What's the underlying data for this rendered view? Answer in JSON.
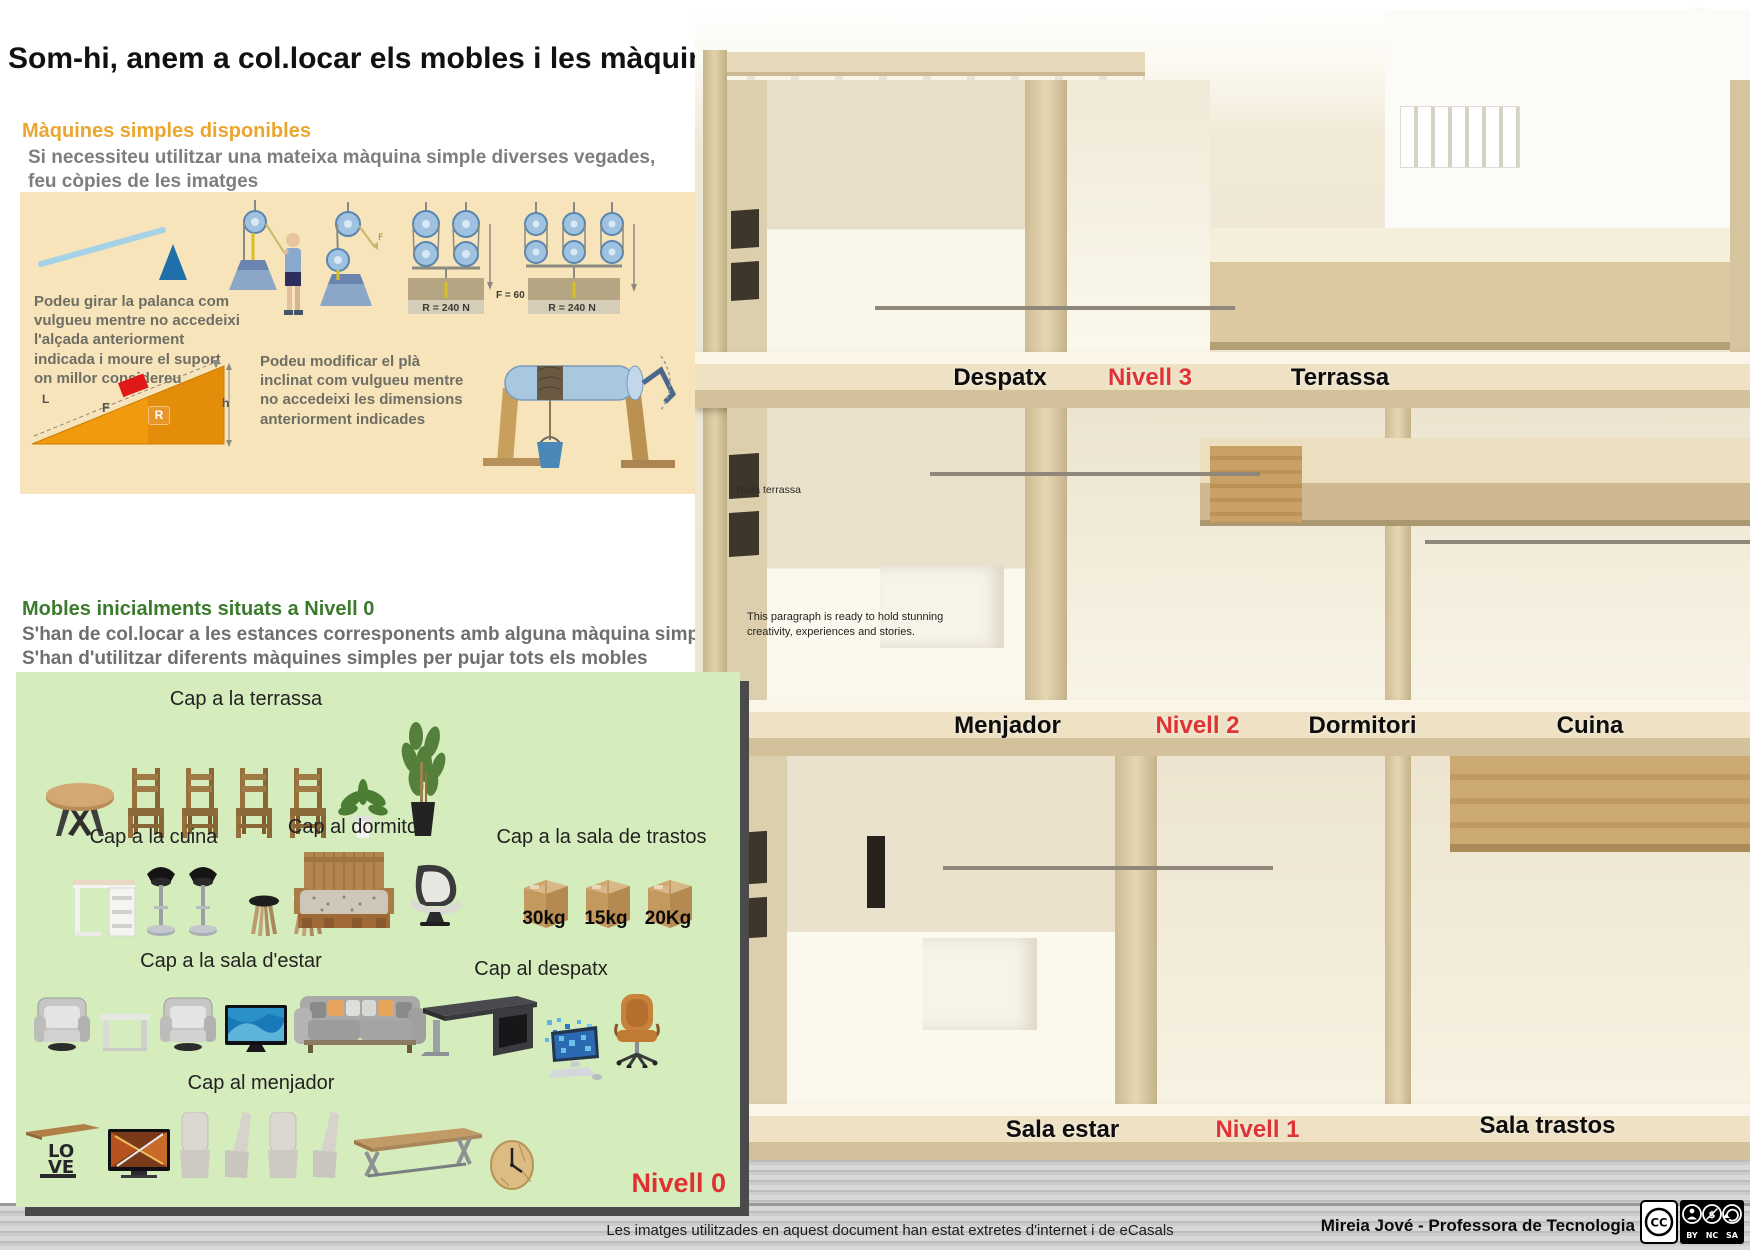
{
  "colors": {
    "accent_red": "#e03131",
    "heading_orange": "#eaa62e",
    "heading_green": "#3c7a2e",
    "tan_panel": "#f7e4ba",
    "green_panel": "#d5ecbc"
  },
  "header": {
    "title": "Som-hi, anem a col.locar els mobles i les màquines simples!!!",
    "back_line1": "A doc.",
    "back_line2": "anterior"
  },
  "machines": {
    "heading": "Màquines simples disponibles",
    "subheading": "Si necessiteu utilitzar una mateixa màquina simple diverses vegades, feu còpies de les imatges",
    "note_lever": "Podeu girar la palanca com vulgueu mentre no accedeixi l'alçada anteriorment indicada i moure el suport on millor considereu",
    "note_plane": "Podeu modificar el plà inclinat com vulgueu mentre no accedeixi les dimensions anteriorment indicades",
    "labels": {
      "r240_a": "R = 240 N",
      "f60": "F = 60 N",
      "r240_b": "R = 240 N",
      "plane_L": "L",
      "plane_F": "F",
      "plane_R": "R",
      "plane_h": "h"
    }
  },
  "furniture": {
    "heading": "Mobles inicialments situats a Nivell 0",
    "rule1": "S'han de col.locar a les estances corresponents amb alguna màquina simple",
    "rule2": "S'han d'utilitzar diferents màquines simples per pujar tots els mobles",
    "level_label": "Nivell 0",
    "groups": [
      {
        "label": "Cap a la terrassa",
        "items": [
          "table-round",
          "chair-wood",
          "chair-wood",
          "chair-wood",
          "chair-wood",
          "plant-small",
          "plant-tall"
        ]
      },
      {
        "label": "Cap a la cuina",
        "items": [
          "bar-table",
          "bar-stool",
          "bar-stool",
          "stool-dark",
          "stool-white"
        ]
      },
      {
        "label": "Cap al dormitori",
        "items": [
          "bed-pallet",
          "lounge-chair"
        ]
      },
      {
        "label": "Cap a la sala de trastos",
        "items": [
          {
            "type": "box",
            "label": "30kg"
          },
          {
            "type": "box",
            "label": "15kg"
          },
          {
            "type": "box",
            "label": "20Kg"
          }
        ]
      },
      {
        "label": "Cap a la sala d'estar",
        "items": [
          "armchair-silver",
          "side-table",
          "armchair-silver",
          "tv-blue",
          "sofa-gray"
        ]
      },
      {
        "label": "Cap al despatx",
        "items": [
          "desk-dark",
          "computer",
          "office-chair"
        ]
      },
      {
        "label": "Cap al menjador",
        "items": [
          "console-love",
          "tv-orange",
          "chair-upholstered",
          "chair-upholstered-side",
          "chair-upholstered",
          "chair-upholstered-side",
          "dining-table",
          "clock-wood"
        ]
      }
    ]
  },
  "house": {
    "labels": {
      "despatx": "Despatx",
      "nivell3": "Nivell 3",
      "terrassa": "Terrassa",
      "menjador": "Menjador",
      "nivell2": "Nivell 2",
      "dormitori": "Dormitori",
      "cuina": "Cuina",
      "sala_estar": "Sala estar",
      "nivell1": "Nivell 1",
      "sala_trastos": "Sala trastos"
    },
    "annotations": {
      "taula": "Taula terrassa",
      "paragraph": "This paragraph is ready to hold stunning creativity, experiences and stories."
    }
  },
  "footer": {
    "credit": "Les imatges utilitzades en aquest document han estat extretes d'internet i de eCasals",
    "author": "Mireia Jové - Professora de Tecnologia",
    "license": {
      "cc": "CC",
      "by": "BY",
      "nc": "NC",
      "sa": "SA"
    }
  }
}
